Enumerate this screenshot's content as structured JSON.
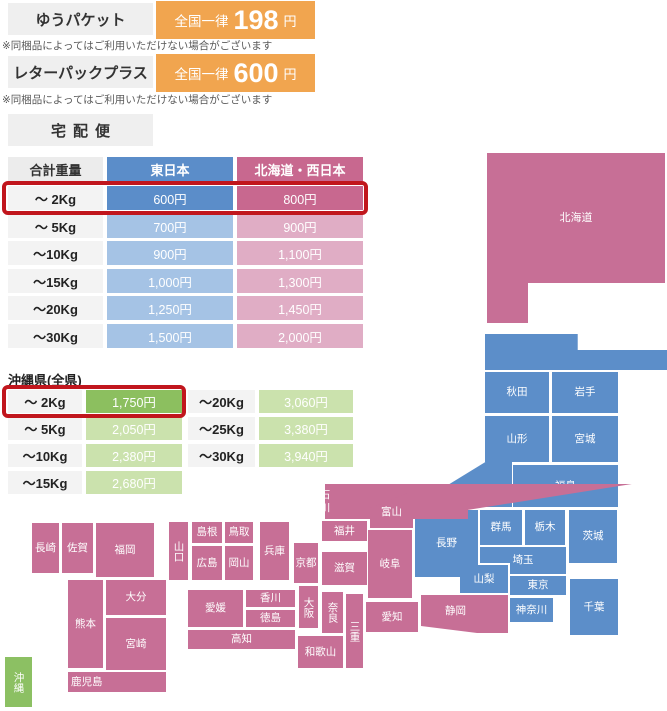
{
  "options": [
    {
      "name": "ゆうパケット",
      "prefix": "全国一律",
      "amount": "198",
      "unit": "円",
      "note": "※同梱品によってはご利用いただけない場合がございます"
    },
    {
      "name": "レターパックプラス",
      "prefix": "全国一律",
      "amount": "600",
      "unit": "円",
      "note": "※同梱品によってはご利用いただけない場合がございます"
    }
  ],
  "takuhai": {
    "title": "宅配便",
    "headers": {
      "weight": "合計重量",
      "east": "東日本",
      "west": "北海道・西日本"
    },
    "rows": [
      {
        "weight": "〜 2Kg",
        "east": "600円",
        "west": "800円",
        "highlight": true
      },
      {
        "weight": "〜 5Kg",
        "east": "700円",
        "west": "900円",
        "highlight": false
      },
      {
        "weight": "〜10Kg",
        "east": "900円",
        "west": "1,100円",
        "highlight": false
      },
      {
        "weight": "〜15Kg",
        "east": "1,000円",
        "west": "1,300円",
        "highlight": false
      },
      {
        "weight": "〜20Kg",
        "east": "1,250円",
        "west": "1,450円",
        "highlight": false
      },
      {
        "weight": "〜30Kg",
        "east": "1,500円",
        "west": "2,000円",
        "highlight": false
      }
    ]
  },
  "okinawa": {
    "title": "沖縄県(全県)",
    "left_rows": [
      {
        "weight": "〜 2Kg",
        "price": "1,750円",
        "highlight": true
      },
      {
        "weight": "〜 5Kg",
        "price": "2,050円",
        "highlight": false
      },
      {
        "weight": "〜10Kg",
        "price": "2,380円",
        "highlight": false
      },
      {
        "weight": "〜15Kg",
        "price": "2,680円",
        "highlight": false
      }
    ],
    "right_rows": [
      {
        "weight": "〜20Kg",
        "price": "3,060円"
      },
      {
        "weight": "〜25Kg",
        "price": "3,380円"
      },
      {
        "weight": "〜30Kg",
        "price": "3,940円"
      }
    ]
  },
  "map": {
    "legend": {
      "east": "東日本",
      "west": "北海道・西日本",
      "okinawa": "沖縄"
    },
    "prefectures": [
      {
        "id": "hokkaido",
        "name": "北海道",
        "region": "west",
        "pos": [
          487,
          153,
          178,
          130
        ]
      },
      {
        "id": "hokkaido-ext",
        "name": "",
        "region": "west",
        "pos": [
          487,
          283,
          41,
          40
        ]
      },
      {
        "id": "aomori",
        "name": "青森",
        "region": "east",
        "pos": [
          485,
          334,
          133,
          36
        ]
      },
      {
        "id": "akita",
        "name": "秋田",
        "region": "east",
        "pos": [
          485,
          372,
          64,
          41
        ]
      },
      {
        "id": "iwate",
        "name": "岩手",
        "region": "east",
        "pos": [
          552,
          372,
          66,
          41
        ]
      },
      {
        "id": "yamagata",
        "name": "山形",
        "region": "east",
        "pos": [
          485,
          416,
          64,
          46
        ]
      },
      {
        "id": "miyagi",
        "name": "宮城",
        "region": "east",
        "pos": [
          552,
          416,
          66,
          46
        ]
      },
      {
        "id": "fukushima",
        "name": "福島",
        "region": "east",
        "pos": [
          513,
          465,
          105,
          42
        ]
      },
      {
        "id": "niigata",
        "name": "新潟",
        "region": "east",
        "pos": [
          412,
          461,
          100,
          46
        ]
      },
      {
        "id": "nagano",
        "name": "長野",
        "region": "east",
        "pos": [
          415,
          510,
          63,
          67
        ]
      },
      {
        "id": "gunma",
        "name": "群馬",
        "region": "east",
        "pos": [
          480,
          510,
          42,
          35
        ]
      },
      {
        "id": "tochigi",
        "name": "栃木",
        "region": "east",
        "pos": [
          525,
          510,
          40,
          35
        ]
      },
      {
        "id": "ibaraki",
        "name": "茨城",
        "region": "east",
        "pos": [
          569,
          510,
          48,
          53
        ]
      },
      {
        "id": "saitama",
        "name": "埼玉",
        "region": "east",
        "pos": [
          480,
          547,
          86,
          27
        ]
      },
      {
        "id": "yamanashi",
        "name": "山梨",
        "region": "east",
        "pos": [
          460,
          565,
          48,
          28
        ]
      },
      {
        "id": "tokyo",
        "name": "東京",
        "region": "east",
        "pos": [
          510,
          576,
          56,
          19
        ]
      },
      {
        "id": "kanagawa",
        "name": "神奈川",
        "region": "east",
        "pos": [
          510,
          598,
          43,
          24
        ]
      },
      {
        "id": "chiba",
        "name": "千葉",
        "region": "east",
        "pos": [
          570,
          579,
          48,
          56
        ]
      },
      {
        "id": "ishikawa",
        "name": "石川",
        "region": "west",
        "pos": [
          325,
          484,
          88,
          35
        ]
      },
      {
        "id": "toyama",
        "name": "富山",
        "region": "west",
        "pos": [
          370,
          487,
          43,
          41
        ]
      },
      {
        "id": "fukui",
        "name": "福井",
        "region": "west",
        "pos": [
          322,
          521,
          45,
          20
        ]
      },
      {
        "id": "shiga",
        "name": "滋賀",
        "region": "west",
        "pos": [
          322,
          552,
          45,
          33
        ]
      },
      {
        "id": "gifu",
        "name": "岐阜",
        "region": "west",
        "pos": [
          368,
          530,
          44,
          68
        ]
      },
      {
        "id": "kyoto",
        "name": "京都",
        "region": "west",
        "pos": [
          294,
          543,
          24,
          40
        ]
      },
      {
        "id": "osaka",
        "name": "大阪",
        "region": "west",
        "pos": [
          299,
          586,
          19,
          42
        ],
        "vertical": true
      },
      {
        "id": "nara",
        "name": "奈良",
        "region": "west",
        "pos": [
          322,
          592,
          21,
          41
        ],
        "vertical": true
      },
      {
        "id": "mie",
        "name": "三重",
        "region": "west",
        "pos": [
          346,
          594,
          17,
          74
        ],
        "vertical": true
      },
      {
        "id": "wakayama",
        "name": "和歌山",
        "region": "west",
        "pos": [
          298,
          636,
          45,
          32
        ]
      },
      {
        "id": "aichi",
        "name": "愛知",
        "region": "west",
        "pos": [
          366,
          602,
          52,
          30
        ]
      },
      {
        "id": "shizuoka",
        "name": "静岡",
        "region": "west",
        "pos": [
          421,
          595,
          87,
          38
        ]
      },
      {
        "id": "hyogo",
        "name": "兵庫",
        "region": "west",
        "pos": [
          260,
          522,
          29,
          58
        ]
      },
      {
        "id": "tottori",
        "name": "鳥取",
        "region": "west",
        "pos": [
          225,
          522,
          28,
          21
        ]
      },
      {
        "id": "shimane",
        "name": "島根",
        "region": "west",
        "pos": [
          192,
          522,
          30,
          21
        ]
      },
      {
        "id": "okayama",
        "name": "岡山",
        "region": "west",
        "pos": [
          225,
          546,
          28,
          34
        ]
      },
      {
        "id": "hiroshima",
        "name": "広島",
        "region": "west",
        "pos": [
          192,
          546,
          30,
          34
        ]
      },
      {
        "id": "yamaguchi",
        "name": "山口",
        "region": "west",
        "pos": [
          169,
          522,
          19,
          58
        ],
        "vertical": true
      },
      {
        "id": "ehime",
        "name": "愛媛",
        "region": "west",
        "pos": [
          188,
          590,
          55,
          37
        ]
      },
      {
        "id": "kagawa",
        "name": "香川",
        "region": "west",
        "pos": [
          246,
          590,
          49,
          17
        ]
      },
      {
        "id": "tokushima",
        "name": "徳島",
        "region": "west",
        "pos": [
          246,
          610,
          49,
          17
        ]
      },
      {
        "id": "kochi",
        "name": "高知",
        "region": "west",
        "pos": [
          188,
          630,
          107,
          19
        ]
      },
      {
        "id": "nagasaki",
        "name": "長崎",
        "region": "west",
        "pos": [
          32,
          523,
          27,
          50
        ]
      },
      {
        "id": "saga",
        "name": "佐賀",
        "region": "west",
        "pos": [
          62,
          523,
          31,
          50
        ]
      },
      {
        "id": "fukuoka",
        "name": "福岡",
        "region": "west",
        "pos": [
          96,
          523,
          58,
          54
        ]
      },
      {
        "id": "kumamoto",
        "name": "熊本",
        "region": "west",
        "pos": [
          68,
          580,
          35,
          88
        ]
      },
      {
        "id": "oita",
        "name": "大分",
        "region": "west",
        "pos": [
          106,
          580,
          60,
          35
        ]
      },
      {
        "id": "miyazaki",
        "name": "宮崎",
        "region": "west",
        "pos": [
          106,
          618,
          60,
          52
        ]
      },
      {
        "id": "kagoshima",
        "name": "鹿児島",
        "region": "west",
        "pos": [
          68,
          672,
          98,
          20
        ]
      },
      {
        "id": "okinawa",
        "name": "沖縄",
        "region": "oki",
        "pos": [
          5,
          657,
          27,
          50
        ],
        "vertical": true
      }
    ]
  },
  "colors": {
    "east_blue": "#5B8DC9",
    "east_blue_light": "#A5C3E5",
    "west_pink": "#C8688F",
    "west_pink_light": "#E0ADC5",
    "map_pink": "#C76F96",
    "map_blue": "#5C8EC9",
    "okinawa_green": "#8CBF5F",
    "okinawa_green_light": "#CBE2AD",
    "map_green": "#8CC063",
    "accent_orange": "#F1A54F",
    "highlight_red": "#C1161D",
    "label_gray": "#EFEFEF"
  }
}
